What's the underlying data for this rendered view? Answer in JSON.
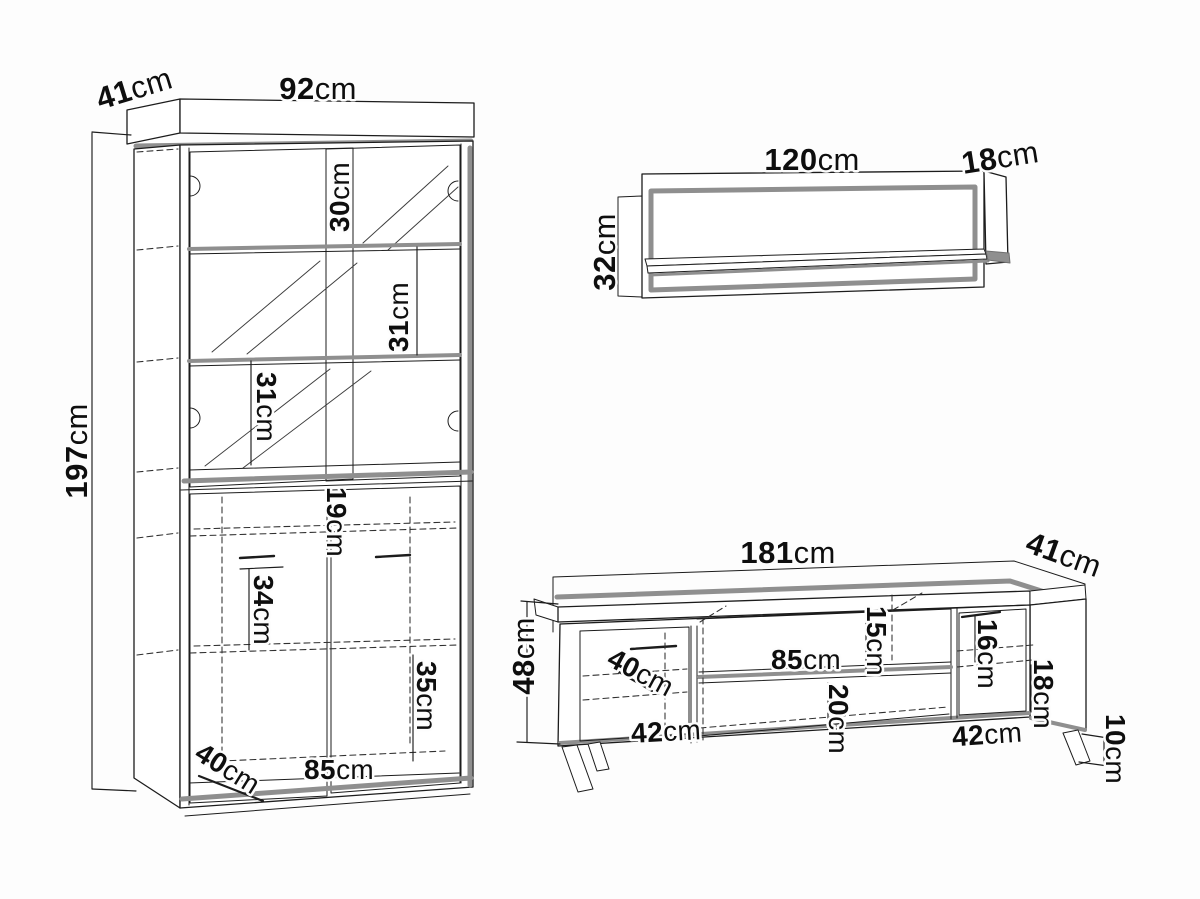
{
  "figure": {
    "kind": "furniture technical drawing",
    "unit": "cm"
  },
  "cabinet": {
    "name": "display cabinet",
    "depth": {
      "v": "41",
      "u": "cm"
    },
    "width": {
      "v": "92",
      "u": "cm"
    },
    "height": {
      "v": "197",
      "u": "cm"
    },
    "top_section": {
      "v": "30",
      "u": "cm"
    },
    "upper_section": {
      "v": "31",
      "u": "cm"
    },
    "middle_section": {
      "v": "31",
      "u": "cm"
    },
    "shelf_gap": {
      "v": "19",
      "u": "cm"
    },
    "lower_section": {
      "v": "34",
      "u": "cm"
    },
    "bottom_section": {
      "v": "35",
      "u": "cm"
    },
    "interior_depth": {
      "v": "40",
      "u": "cm"
    },
    "interior_width": {
      "v": "85",
      "u": "cm"
    }
  },
  "wall_shelf": {
    "name": "wall shelf",
    "width": {
      "v": "120",
      "u": "cm"
    },
    "depth": {
      "v": "18",
      "u": "cm"
    },
    "height": {
      "v": "32",
      "u": "cm"
    }
  },
  "tv_stand": {
    "name": "TV stand",
    "width": {
      "v": "181",
      "u": "cm"
    },
    "depth": {
      "v": "41",
      "u": "cm"
    },
    "height": {
      "v": "48",
      "u": "cm"
    },
    "interior_depth": {
      "v": "40",
      "u": "cm"
    },
    "left_door_width": {
      "v": "42",
      "u": "cm"
    },
    "shelf_width": {
      "v": "85",
      "u": "cm"
    },
    "upper_shelf_height": {
      "v": "15",
      "u": "cm"
    },
    "lower_opening_height": {
      "v": "20",
      "u": "cm"
    },
    "right_upper_height": {
      "v": "16",
      "u": "cm"
    },
    "right_lower_height": {
      "v": "18",
      "u": "cm"
    },
    "right_door_width": {
      "v": "42",
      "u": "cm"
    },
    "leg_height": {
      "v": "10",
      "u": "cm"
    }
  },
  "colors": {
    "line": "#1c1c1c",
    "accent": "#8f8f8f",
    "background": "#fdfdfd"
  }
}
